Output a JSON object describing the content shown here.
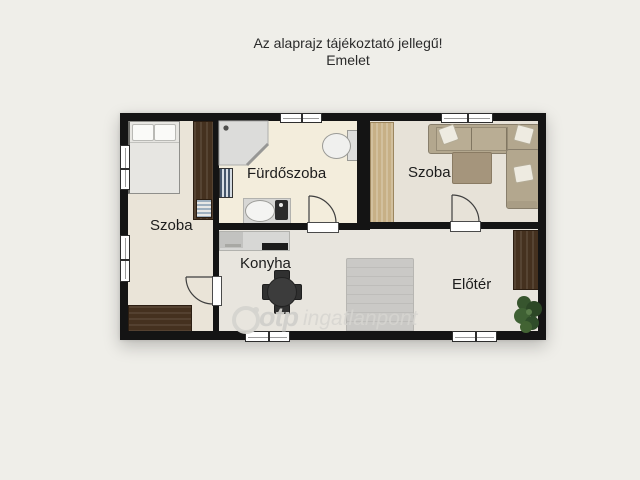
{
  "header": {
    "line1": "Az alaprajz tájékoztató jellegű!",
    "line2": "Emelet"
  },
  "rooms": {
    "szoba_left": {
      "label": "Szoba"
    },
    "furdoszoba": {
      "label": "Fürdőszoba"
    },
    "szoba_right": {
      "label": "Szoba"
    },
    "konyha": {
      "label": "Konyha"
    },
    "eloter": {
      "label": "Előtér"
    }
  },
  "watermark": {
    "brand": "otp",
    "suffix": "ingatlanpont",
    "logo": "otp-circle-logo"
  },
  "furniture": {
    "szoba_left": [
      "double-bed",
      "wardrobe",
      "desk"
    ],
    "furdoszoba": [
      "corner-shower",
      "toilet",
      "towel-radiator",
      "sink-counter",
      "washing-machine"
    ],
    "szoba_right": [
      "corner-sofa",
      "coffee-table",
      "wardrobe"
    ],
    "konyha": [
      "kitchen-counter",
      "cooktop",
      "round-dining-table",
      "four-chairs"
    ],
    "eloter": [
      "staircase",
      "cabinet",
      "potted-plant"
    ]
  },
  "colors": {
    "background": "#efeee9",
    "wall": "#141414",
    "floor_bedroom": "#eae4d8",
    "floor_bathroom": "#f3eddc",
    "floor_room2": "#e7e2d8",
    "floor_hall": "#e8e5de",
    "dark_wood": "#45311f",
    "light_wood": "#c7b086",
    "sofa": "#b3a78e",
    "stairs": "#cac9c6",
    "plant": "#37552e"
  }
}
